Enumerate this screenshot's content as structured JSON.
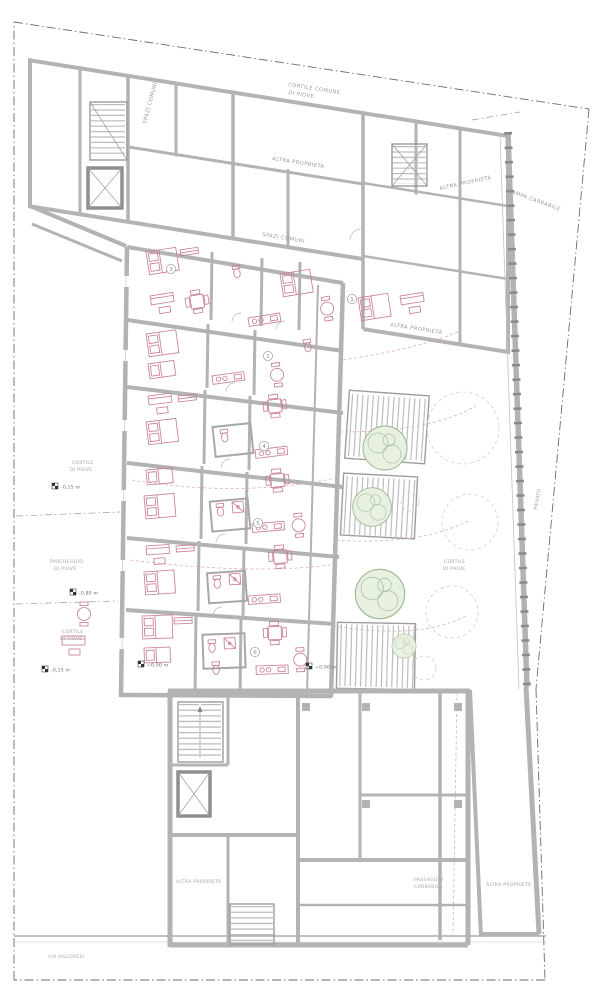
{
  "labels": {
    "cortile_comune_1": "CORTILE COMUNE",
    "cortile_comune_2": "DI PIOVE",
    "spazi_comuni_v": "SPAZI COMUNI",
    "spazi_comuni": "SPAZI COMUNI",
    "altra_proprieta_top": "ALTRA PROPRIETÀ",
    "altra_proprieta_topright": "ALTRA PROPRIETÀ",
    "rampa_carrabile": "RAMPA CARRABILE",
    "altra_proprieta_mid": "ALTRA PROPRIETÀ",
    "cortile_left1_1": "CORTILE",
    "cortile_left1_2": "DI PIOVE",
    "parcheggio_1": "PARCHEGGIO",
    "parcheggio_2": "DI PIOVE",
    "cortile_left2_1": "CORTILE",
    "cortile_left2_2": "DI PIOVE",
    "cortile_right_1": "CORTILE",
    "cortile_right_2": "DI PIOVE",
    "privato": "PRIVATO",
    "altra_proprieta_bl": "ALTRA PROPRIETÀ",
    "passaggio_1": "PASSAGGIO",
    "passaggio_2": "CARRABILE",
    "altra_proprieta_br": "ALTRA PROPRIETÀ",
    "via_villoresi": "VIA VILLORESI"
  },
  "levels": [
    {
      "value": "-0,15 m"
    },
    {
      "value": "-0,80 m"
    },
    {
      "value": "-0,15 m"
    },
    {
      "value": "+0,90 m"
    },
    {
      "value": "+0,90 m"
    }
  ],
  "units": [
    "1",
    "2",
    "3",
    "4",
    "5",
    "6"
  ],
  "colors": {
    "wall": "#b3b3b3",
    "wall_dark": "#8f8f8f",
    "furniture": "#c97f99",
    "tree_stroke": "#9cb88f",
    "tree_fill": "#e8f0e2",
    "text": "#9a9a9a",
    "boundary": "#6b6b6b"
  }
}
